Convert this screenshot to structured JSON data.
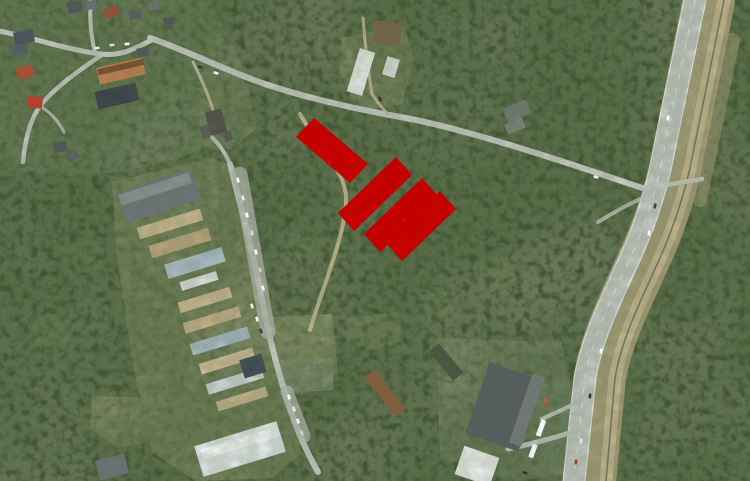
{
  "meta": {
    "view": "aerial-satellite-map",
    "width": 750,
    "height": 481
  },
  "palette": {
    "forest_base": "#44503a",
    "overlay_red": "#ee0404",
    "overlay_red_dark": "#7a0000",
    "road_gray": "#c6cac5",
    "sand": "#c2b28b"
  },
  "overlay": {
    "name": "highlighted-parcels",
    "color": "#ee0404",
    "parcels": [
      {
        "id": "parcel-1",
        "points": "296,137 314,118 368,164 350,183"
      },
      {
        "id": "parcel-2",
        "points": "338,213 396,157 412,175 354,231"
      },
      {
        "id": "parcel-3",
        "points": "364,234 422,178 438,196 380,252"
      },
      {
        "id": "parcel-4",
        "points": "386,243 440,191 456,209 402,261"
      }
    ]
  },
  "patches": [
    {
      "name": "village-ground",
      "points": "0,0 210,0 238,55 250,92 232,138 180,158 120,172 60,176 0,168",
      "fill": "#7e8870",
      "opacity": 0.9
    },
    {
      "name": "industrial-yard",
      "points": "112,182 212,158 242,170 258,265 272,340 292,405 302,452 272,478 196,481 152,452 132,360 116,250",
      "fill": "#c2b28b",
      "opacity": 0.92
    },
    {
      "name": "sand-pit",
      "points": "252,318 332,314 338,372 302,395 260,382",
      "fill": "#ccbe94",
      "opacity": 0.95
    },
    {
      "name": "concrete-pad",
      "points": "280,360 332,358 334,390 286,393",
      "fill": "#e8e8e2",
      "opacity": 0.95
    },
    {
      "name": "compound-gravel",
      "points": "342,38 404,26 414,58 402,104 358,112 340,72",
      "fill": "#b4a985",
      "opacity": 0.88
    },
    {
      "name": "ruins-clearing",
      "points": "193,93 247,90 257,128 231,150 198,146",
      "fill": "#aaa384",
      "opacity": 0.8
    },
    {
      "name": "bottom-left-clearing",
      "points": "92,396 160,398 158,442 118,448 90,428",
      "fill": "#c2b48d",
      "opacity": 0.9
    },
    {
      "name": "store-ground",
      "points": "436,338 562,342 578,472 516,481 440,458",
      "fill": "#9b9b8d",
      "opacity": 0.85
    },
    {
      "name": "store-parking",
      "points": "533,383 570,378 578,466 546,472",
      "fill": "#b4b7b1",
      "opacity": 0.9
    },
    {
      "name": "meadow",
      "points": "348,318 398,312 404,340 370,350 346,340",
      "fill": "#76855e",
      "opacity": 0.8
    },
    {
      "name": "scrub-1",
      "points": "286,236 320,228 330,252 300,262",
      "fill": "#6d7b57",
      "opacity": 0.6
    },
    {
      "name": "scrub-2",
      "points": "60,246 96,240 104,268 70,276",
      "fill": "#6d7b57",
      "opacity": 0.55
    },
    {
      "name": "scrub-3",
      "points": "30,318 66,312 74,342 38,350",
      "fill": "#6d7b57",
      "opacity": 0.55
    },
    {
      "name": "scrub-4",
      "points": "420,296 456,290 464,316 430,324",
      "fill": "#6d7b57",
      "opacity": 0.55
    },
    {
      "name": "scrub-5",
      "points": "472,262 508,256 516,282 482,290",
      "fill": "#6d7b57",
      "opacity": 0.5
    }
  ],
  "roads": [
    {
      "name": "highway-verge",
      "d": "M709,0 L675,169 Q665,213 645,257 C625,301 607,337 600,377 L590,481",
      "width": 52,
      "color": "#b0a57f",
      "opacity": 0.85
    },
    {
      "name": "railway-strip",
      "d": "M724,0 L690,168 Q680,212 660,258 C640,302 622,338 615,378 L606,481",
      "width": 13,
      "color": "#c3b58d",
      "opacity": 1
    },
    {
      "name": "railway-rail",
      "d": "M724,0 L690,168 Q680,212 660,258 C640,302 622,338 615,378 L606,481",
      "width": 1.6,
      "color": "#6e6e64",
      "opacity": 0.9
    },
    {
      "name": "highway-roadway",
      "d": "M695,0 L660,170 Q650,214 630,258 C610,302 592,338 585,378 L574,481",
      "width": 22,
      "color": "#c3c7c2",
      "opacity": 1
    },
    {
      "name": "highway-edge-west",
      "d": "M684,0 L649,170 Q639,214 619,258 C599,302 581,338 574,378 L563,481",
      "width": 1.2,
      "color": "#eff1ee",
      "opacity": 0.85
    },
    {
      "name": "highway-edge-east",
      "d": "M706,0 L671,170 Q661,214 641,258 C621,302 603,338 596,378 L585,481",
      "width": 1.2,
      "color": "#eff1ee",
      "opacity": 0.85
    },
    {
      "name": "highway-center-line",
      "d": "M695,0 L660,170 Q650,214 630,258 C610,302 592,338 585,378 L574,481",
      "width": 0.8,
      "color": "#ffffff",
      "opacity": 0.75,
      "dash": "6 9"
    },
    {
      "name": "east-scrub-track",
      "d": "M733,40 L700,200",
      "width": 14,
      "color": "#ab9f79",
      "opacity": 0.5
    },
    {
      "name": "diagonal-road",
      "d": "M150,38 C185,50 225,70 262,83 C300,96 350,108 395,116 C460,127 560,160 648,190",
      "width": 6,
      "color": "#c6cac5",
      "opacity": 1
    },
    {
      "name": "intersection-stub-east",
      "d": "M660,186 L702,179",
      "width": 4.5,
      "color": "#c6cac5",
      "opacity": 1
    },
    {
      "name": "intersection-flare",
      "d": "M598,222 C618,210 632,202 650,195",
      "width": 4,
      "color": "#c6cac5",
      "opacity": 0.8
    },
    {
      "name": "village-main-road",
      "d": "M0,31 C40,40 70,50 100,54 C125,57 140,45 152,40",
      "width": 5,
      "color": "#c6cac5",
      "opacity": 1
    },
    {
      "name": "village-north-branch",
      "d": "M95,53 C91,36 89,18 91,0",
      "width": 4,
      "color": "#c6cac5",
      "opacity": 0.95
    },
    {
      "name": "village-street",
      "d": "M100,56 C80,70 56,86 40,106 C30,120 25,140 23,162",
      "width": 4.5,
      "color": "#c6cac5",
      "opacity": 0.95
    },
    {
      "name": "village-spur",
      "d": "M40,106 C50,112 58,120 64,132",
      "width": 3,
      "color": "#c6cac5",
      "opacity": 0.85
    },
    {
      "name": "ruins-driveway",
      "d": "M193,62 C201,78 208,94 213,110",
      "width": 3,
      "color": "#c9bd9a",
      "opacity": 0.9
    },
    {
      "name": "compound-track-north",
      "d": "M363,18 C365,44 368,70 372,94",
      "width": 3,
      "color": "#c4b891",
      "opacity": 0.9
    },
    {
      "name": "compound-driveway",
      "d": "M372,94 C377,102 382,108 388,114",
      "width": 3,
      "color": "#c4b891",
      "opacity": 0.9
    },
    {
      "name": "pit-track",
      "d": "M300,114 C320,150 346,172 346,198 C346,235 322,288 310,330",
      "width": 4,
      "color": "#ccbe96",
      "opacity": 0.9
    },
    {
      "name": "industrial-access-road",
      "d": "M230,164 C242,210 254,258 262,300 C269,338 280,380 294,420 C302,442 310,458 318,472",
      "width": 6,
      "color": "#c7cbc6",
      "opacity": 1
    },
    {
      "name": "industrial-access-north",
      "d": "M230,164 C224,150 216,140 206,132",
      "width": 4,
      "color": "#c7cbc6",
      "opacity": 0.9
    },
    {
      "name": "parking-lot-strip",
      "d": "M240,174 L268,332",
      "width": 15,
      "color": "#b5b9b3",
      "opacity": 0.75
    },
    {
      "name": "parking-bays",
      "d": "M287,392 L304,436",
      "width": 13,
      "color": "#b5b9b3",
      "opacity": 0.75
    },
    {
      "name": "store-access-road",
      "d": "M578,430 C558,437 535,443 508,449",
      "width": 5,
      "color": "#bfc3bd",
      "opacity": 1
    },
    {
      "name": "store-spur",
      "d": "M581,401 C566,408 553,414 542,419",
      "width": 4,
      "color": "#bfc3bd",
      "opacity": 0.95
    }
  ],
  "buildings": [
    {
      "name": "top-house-1",
      "cx": 75,
      "cy": 7,
      "w": 15,
      "h": 11,
      "rot": -10,
      "fill": "#4d545c"
    },
    {
      "name": "top-house-2",
      "cx": 91,
      "cy": 5,
      "w": 11,
      "h": 9,
      "rot": -10,
      "fill": "#6a7077"
    },
    {
      "name": "top-house-red",
      "cx": 111,
      "cy": 12,
      "w": 14,
      "h": 10,
      "rot": -12,
      "fill": "#a14a32"
    },
    {
      "name": "top-house-4",
      "cx": 135,
      "cy": 15,
      "w": 12,
      "h": 9,
      "rot": -10,
      "fill": "#575d64"
    },
    {
      "name": "top-house-5",
      "cx": 154,
      "cy": 6,
      "w": 11,
      "h": 8,
      "rot": -8,
      "fill": "#6d7378"
    },
    {
      "name": "top-house-6",
      "cx": 169,
      "cy": 21,
      "w": 11,
      "h": 8,
      "rot": -10,
      "fill": "#50565d"
    },
    {
      "name": "nw-house-dark-1",
      "cx": 24,
      "cy": 37,
      "w": 20,
      "h": 13,
      "rot": -12,
      "fill": "#47525f"
    },
    {
      "name": "nw-house-dark-2",
      "cx": 20,
      "cy": 50,
      "w": 15,
      "h": 10,
      "rot": -12,
      "fill": "#525c68"
    },
    {
      "name": "nw-house-red-1",
      "cx": 25,
      "cy": 72,
      "w": 16,
      "h": 12,
      "rot": -14,
      "fill": "#b54a30"
    },
    {
      "name": "nw-house-red-2",
      "cx": 35,
      "cy": 102,
      "w": 15,
      "h": 12,
      "rot": 6,
      "fill": "#bf3c29"
    },
    {
      "name": "orange-apartment-block",
      "cx": 121,
      "cy": 71,
      "w": 47,
      "h": 17,
      "rot": -13,
      "fill": "#c57e50"
    },
    {
      "name": "orange-apartment-ridge",
      "cx": 121,
      "cy": 67,
      "w": 47,
      "h": 6,
      "rot": -13,
      "fill": "#7c4a2e"
    },
    {
      "name": "dark-apartment-block",
      "cx": 117,
      "cy": 96,
      "w": 42,
      "h": 18,
      "rot": -13,
      "fill": "#3a4047"
    },
    {
      "name": "village-house-7",
      "cx": 143,
      "cy": 52,
      "w": 12,
      "h": 9,
      "rot": -12,
      "fill": "#50565d"
    },
    {
      "name": "village-house-8",
      "cx": 60,
      "cy": 147,
      "w": 13,
      "h": 10,
      "rot": -12,
      "fill": "#4d535a"
    },
    {
      "name": "village-house-9",
      "cx": 73,
      "cy": 155,
      "w": 10,
      "h": 8,
      "rot": -12,
      "fill": "#5a6067"
    },
    {
      "name": "ruin-building-1",
      "cx": 216,
      "cy": 122,
      "w": 17,
      "h": 24,
      "rot": -14,
      "fill": "#4e4f49"
    },
    {
      "name": "ruin-building-2",
      "cx": 205,
      "cy": 132,
      "w": 9,
      "h": 13,
      "rot": -14,
      "fill": "#5c5d56"
    },
    {
      "name": "ruin-building-3",
      "cx": 228,
      "cy": 136,
      "w": 8,
      "h": 10,
      "rot": -14,
      "fill": "#56574f"
    },
    {
      "name": "gray-industrial-hall",
      "cx": 159,
      "cy": 196,
      "w": 78,
      "h": 32,
      "rot": -18,
      "fill": "#6e747a"
    },
    {
      "name": "gray-hall-lit-slope",
      "cx": 155,
      "cy": 189,
      "w": 74,
      "h": 11,
      "rot": -18,
      "fill": "#8b9196"
    },
    {
      "name": "shed-row-1",
      "cx": 170,
      "cy": 224,
      "w": 66,
      "h": 12,
      "rot": -17,
      "fill": "#c7b78f"
    },
    {
      "name": "shed-row-2",
      "cx": 180,
      "cy": 243,
      "w": 62,
      "h": 13,
      "rot": -17,
      "fill": "#b9a67d"
    },
    {
      "name": "shed-row-3-blue",
      "cx": 195,
      "cy": 263,
      "w": 60,
      "h": 15,
      "rot": -17,
      "fill": "#a9bcc6"
    },
    {
      "name": "shed-row-3b-white",
      "cx": 199,
      "cy": 281,
      "w": 38,
      "h": 9,
      "rot": -17,
      "fill": "#dde1e0"
    },
    {
      "name": "shed-row-4",
      "cx": 205,
      "cy": 300,
      "w": 54,
      "h": 11,
      "rot": -17,
      "fill": "#c9b992"
    },
    {
      "name": "shed-row-5",
      "cx": 212,
      "cy": 320,
      "w": 58,
      "h": 11,
      "rot": -17,
      "fill": "#c1af88"
    },
    {
      "name": "shed-row-6-blue",
      "cx": 220,
      "cy": 341,
      "w": 60,
      "h": 12,
      "rot": -17,
      "fill": "#a6bac4"
    },
    {
      "name": "shed-row-7",
      "cx": 227,
      "cy": 361,
      "w": 56,
      "h": 11,
      "rot": -17,
      "fill": "#ccbb94"
    },
    {
      "name": "shed-row-8-white",
      "cx": 235,
      "cy": 381,
      "w": 58,
      "h": 11,
      "rot": -17,
      "fill": "#ccd4d6"
    },
    {
      "name": "shed-row-9",
      "cx": 242,
      "cy": 399,
      "w": 52,
      "h": 10,
      "rot": -17,
      "fill": "#c4b38c"
    },
    {
      "name": "dark-blue-building",
      "cx": 253,
      "cy": 366,
      "w": 23,
      "h": 19,
      "rot": -17,
      "fill": "#3d4954"
    },
    {
      "name": "white-industrial-hall",
      "cx": 240,
      "cy": 449,
      "w": 86,
      "h": 32,
      "rot": -17,
      "fill": "#dfe5e6"
    },
    {
      "name": "white-hall-lit-slope",
      "cx": 240,
      "cy": 443,
      "w": 80,
      "h": 10,
      "rot": -17,
      "fill": "#f2f5f5"
    },
    {
      "name": "bottom-left-gray-building",
      "cx": 112,
      "cy": 467,
      "w": 30,
      "h": 20,
      "rot": -14,
      "fill": "#6d737a"
    },
    {
      "name": "compound-white-barn",
      "cx": 361,
      "cy": 72,
      "w": 16,
      "h": 45,
      "rot": 17,
      "fill": "#e7eae7"
    },
    {
      "name": "compound-white-shed",
      "cx": 391,
      "cy": 67,
      "w": 13,
      "h": 19,
      "rot": 17,
      "fill": "#d9dcd9"
    },
    {
      "name": "compound-rust-structure",
      "cx": 387,
      "cy": 33,
      "w": 28,
      "h": 22,
      "rot": 8,
      "fill": "#77624a"
    },
    {
      "name": "brown-barracks",
      "cx": 385,
      "cy": 393,
      "w": 50,
      "h": 13,
      "rot": 52,
      "fill": "#8a5a3c"
    },
    {
      "name": "green-shed",
      "cx": 446,
      "cy": 362,
      "w": 38,
      "h": 13,
      "rot": 50,
      "fill": "#49523f"
    },
    {
      "name": "forest-ruin-1",
      "cx": 517,
      "cy": 111,
      "w": 25,
      "h": 15,
      "rot": -22,
      "fill": "#6f7970"
    },
    {
      "name": "forest-ruin-2",
      "cx": 515,
      "cy": 126,
      "w": 19,
      "h": 11,
      "rot": -22,
      "fill": "#7b8179"
    },
    {
      "name": "store-roof",
      "cx": 504,
      "cy": 407,
      "w": 56,
      "h": 75,
      "rot": 19,
      "fill": "#565b60"
    },
    {
      "name": "store-roof-light-band",
      "cx": 527,
      "cy": 410,
      "w": 13,
      "h": 73,
      "rot": 19,
      "fill": "#75797d"
    },
    {
      "name": "store-white-annex",
      "cx": 477,
      "cy": 466,
      "w": 37,
      "h": 30,
      "rot": 19,
      "fill": "#edefee"
    }
  ],
  "vehicles": [
    {
      "name": "car",
      "cx": 200,
      "cy": 67,
      "rot": 12,
      "fill": "#343a42"
    },
    {
      "name": "car",
      "cx": 216,
      "cy": 73,
      "rot": 14,
      "fill": "#f2f2f2"
    },
    {
      "name": "car",
      "cx": 97,
      "cy": 48,
      "rot": -8,
      "fill": "#e9ebe9"
    },
    {
      "name": "car",
      "cx": 112,
      "cy": 45,
      "rot": -8,
      "fill": "#d8dad8"
    },
    {
      "name": "car",
      "cx": 127,
      "cy": 44,
      "rot": -8,
      "fill": "#f4f4f4"
    },
    {
      "name": "car",
      "cx": 596,
      "cy": 177,
      "rot": 12,
      "fill": "#ececec"
    },
    {
      "name": "car",
      "cx": 380,
      "cy": 99,
      "rot": 70,
      "fill": "#3e3427"
    },
    {
      "name": "car",
      "cx": 377,
      "cy": 22,
      "rot": 10,
      "fill": "#7a5a3a"
    },
    {
      "name": "car",
      "cx": 238,
      "cy": 180,
      "rot": 73,
      "fill": "#f8f8f8"
    },
    {
      "name": "car",
      "cx": 243,
      "cy": 198,
      "rot": 73,
      "fill": "#e6e8e6"
    },
    {
      "name": "car",
      "cx": 247,
      "cy": 215,
      "rot": 73,
      "fill": "#fdfdfd"
    },
    {
      "name": "car",
      "cx": 252,
      "cy": 233,
      "rot": 73,
      "fill": "#d5d8d5"
    },
    {
      "name": "car",
      "cx": 256,
      "cy": 252,
      "rot": 73,
      "fill": "#fafafa"
    },
    {
      "name": "car",
      "cx": 260,
      "cy": 270,
      "rot": 73,
      "fill": "#c6c9c6"
    },
    {
      "name": "car",
      "cx": 263,
      "cy": 288,
      "rot": 73,
      "fill": "#f6f6f6"
    },
    {
      "name": "car",
      "cx": 252,
      "cy": 306,
      "rot": 73,
      "fill": "#ececec"
    },
    {
      "name": "car",
      "cx": 257,
      "cy": 319,
      "rot": 73,
      "fill": "#f4f4f4"
    },
    {
      "name": "car",
      "cx": 261,
      "cy": 331,
      "rot": 73,
      "fill": "#3a424b"
    },
    {
      "name": "car",
      "cx": 289,
      "cy": 397,
      "rot": 73,
      "fill": "#ffffff"
    },
    {
      "name": "car",
      "cx": 294,
      "cy": 409,
      "rot": 73,
      "fill": "#e8eae8"
    },
    {
      "name": "car",
      "cx": 298,
      "cy": 421,
      "rot": 73,
      "fill": "#f4f4f4"
    },
    {
      "name": "car",
      "cx": 302,
      "cy": 433,
      "rot": 73,
      "fill": "#cdd0cd"
    },
    {
      "name": "truck",
      "cx": 541,
      "cy": 428,
      "w": 5,
      "h": 17,
      "rot": 20,
      "fill": "#f4f6f4"
    },
    {
      "name": "truck",
      "cx": 533,
      "cy": 451,
      "w": 5,
      "h": 14,
      "rot": 20,
      "fill": "#eceeec"
    },
    {
      "name": "pallet-stack",
      "cx": 545,
      "cy": 400,
      "w": 4,
      "h": 3,
      "rot": 20,
      "fill": "#cf5b2e"
    },
    {
      "name": "pallet-stack",
      "cx": 547,
      "cy": 405,
      "w": 4,
      "h": 3,
      "rot": 20,
      "fill": "#c44f28"
    },
    {
      "name": "car",
      "cx": 525,
      "cy": 473,
      "rot": 20,
      "fill": "#2f353c"
    },
    {
      "name": "car",
      "cx": 668,
      "cy": 118,
      "rot": -79,
      "fill": "#fdfdfd"
    },
    {
      "name": "car",
      "cx": 655,
      "cy": 206,
      "rot": -79,
      "fill": "#3c4148"
    },
    {
      "name": "car",
      "cx": 649,
      "cy": 233,
      "rot": -79,
      "fill": "#fafafa"
    },
    {
      "name": "car",
      "cx": 601,
      "cy": 351,
      "rot": -84,
      "fill": "#ffffff"
    },
    {
      "name": "car",
      "cx": 590,
      "cy": 396,
      "rot": -84,
      "fill": "#2e333a"
    },
    {
      "name": "car",
      "cx": 581,
      "cy": 441,
      "rot": -84,
      "fill": "#e9e9e9"
    },
    {
      "name": "car",
      "cx": 576,
      "cy": 462,
      "rot": -84,
      "fill": "#b03a2e"
    }
  ]
}
